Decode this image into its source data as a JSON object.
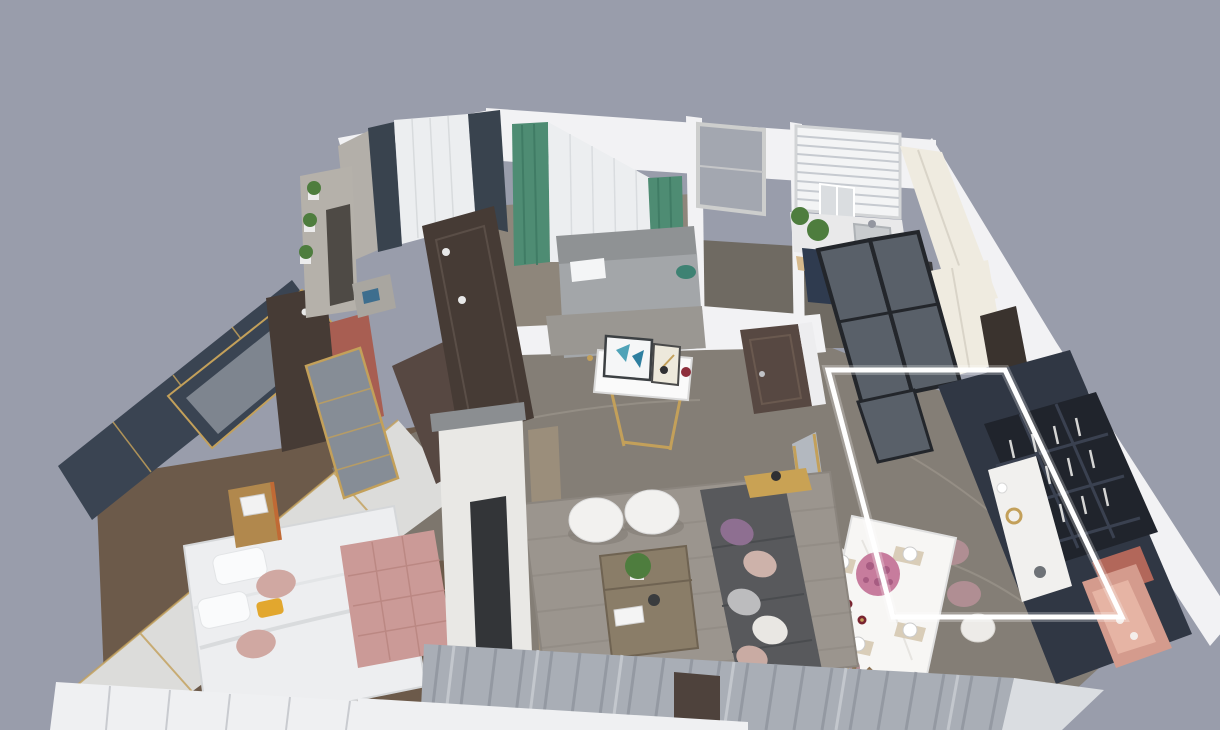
{
  "scene": {
    "description": "Isometric 3D rendered apartment floor plan, top-down view",
    "regions": [
      "master-bedroom",
      "bedroom-2",
      "bathroom",
      "kitchen",
      "foyer",
      "dining-area",
      "living-room",
      "balcony"
    ],
    "highlighted_region": "dining-area"
  },
  "highlight": {
    "points": "828,370 1005,370 1122,617 893,617",
    "color": "#FFFFFF"
  },
  "palette": {
    "background": "#999DAB",
    "wallWhite": "#F2F2F4",
    "wallShade": "#D8D9DD",
    "whiteSill": "#EFF0F2",
    "floorMarble": "#847E76",
    "floorVein": "#A59E94",
    "floorTileDark": "#6F6A62",
    "floorTileBrown": "#7D766D",
    "floorBedroom2": "#8E867B",
    "carpetBrown": "#6C5A4A",
    "runnerTan": "#9B8E7B",
    "marbleWall": "#DCDCDA",
    "navyPanel": "#3A4452",
    "goldAccent": "#C3A05A",
    "glassSpeckle": "#868D96",
    "redPanel": "#A85E52",
    "doorDark": "#463B35",
    "doorBrown": "#574842",
    "curtainGreen": "#4E8C73",
    "curtainGreenDark": "#3F7B64",
    "curtainSheer": "#ECEEF0",
    "curtainDarkNavy": "#39434E",
    "curtainGray": "#A9AEB6",
    "curtainGrayDark": "#8F959E",
    "curtainWhite": "#DADDE1",
    "bedWhite": "#EDEEF0",
    "bedGray": "#A3A6A9",
    "blush": "#D0A8A2",
    "benchPink": "#CB9A97",
    "yellowAccent": "#E2A72E",
    "woodNightstand": "#B1884D",
    "concreteGray": "#B3AFA9",
    "wardrobeGray": "#B5B1AA",
    "kitchenNavy": "#2F3B4F",
    "cabinetCream": "#EFEBE0",
    "counterWhite": "#E9E9EA",
    "cooktopDark": "#3A3A3C",
    "copper": "#A4613B",
    "plantGreen": "#4E7D3E",
    "glassDark": "#596069",
    "frameBlack": "#23262B",
    "tableWhite": "#F7F6F4",
    "mauve": "#B08E93",
    "chairWhite": "#EDEBE8",
    "flowerPink": "#C77C9D",
    "wineDark": "#7A2430",
    "displayNavy": "#303744",
    "displayGlass": "#20242C",
    "nichePink": "#D49B8D",
    "nicheLight": "#E6B4A4",
    "terracotta": "#B2675A",
    "screenMesh": "#B7BDC5",
    "rugGray": "#9B958E",
    "sofaGray": "#58595C",
    "bronze": "#8A7D68",
    "tvDark": "#333538",
    "tvWallMarble": "#E9E8E5",
    "pillowPurple": "#8E6F91"
  }
}
